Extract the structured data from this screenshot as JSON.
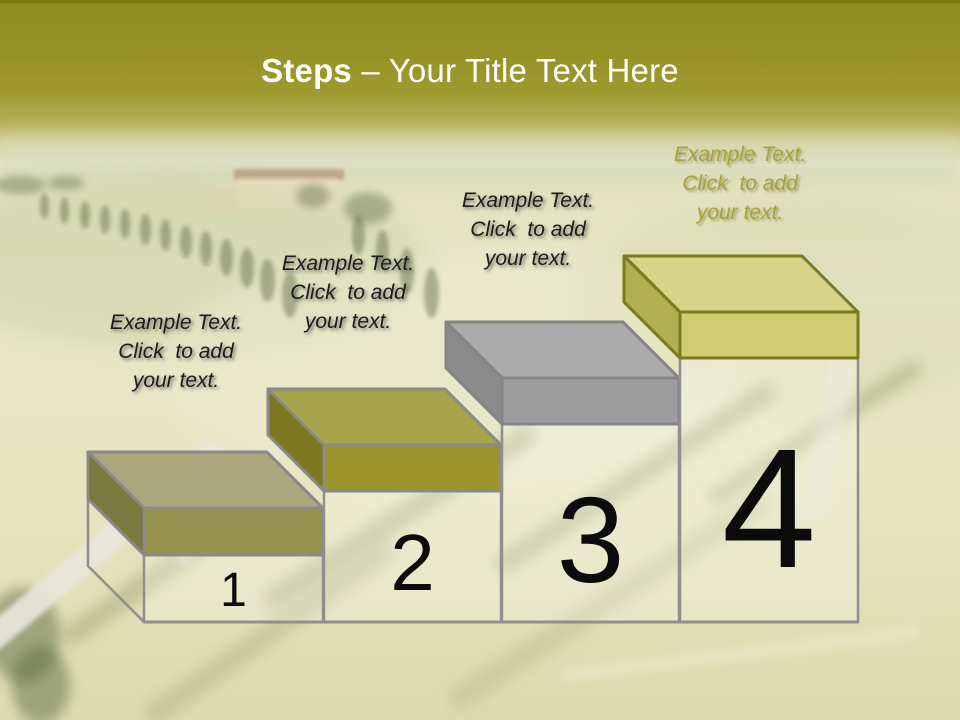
{
  "title": {
    "bold": "Steps",
    "rest": "– Your Title Text Here"
  },
  "theme": {
    "header_top": "#8e8b20",
    "header_bottom": "#a09b30",
    "title_color": "#ffffff",
    "background_field": "#e7e5c0",
    "column_fill": "rgba(255,255,255,0.25)",
    "column_stroke": "#8f8f8f",
    "baseline_color": "#8f8f8f",
    "number_color": "#0b0b0b"
  },
  "steps": [
    {
      "number": "1",
      "label": [
        "Example Text.",
        "Click  to add",
        "your text."
      ],
      "label_color": "#1c1c1c",
      "colors": {
        "top": "#a9a77b",
        "side": "#7b7840",
        "front": "#95914f",
        "outline": "#8a8a8a"
      }
    },
    {
      "number": "2",
      "label": [
        "Example Text.",
        "Click  to add",
        "your text."
      ],
      "label_color": "#1c1c1c",
      "colors": {
        "top": "#a7a348",
        "side": "#7d7820",
        "front": "#9a942a",
        "outline": "#8a8a8a"
      }
    },
    {
      "number": "3",
      "label": [
        "Example Text.",
        "Click  to add",
        "your text."
      ],
      "label_color": "#1c1c1c",
      "colors": {
        "top": "#ababab",
        "side": "#8b8b8b",
        "front": "#9d9d9d",
        "outline": "#858585"
      }
    },
    {
      "number": "4",
      "label": [
        "Example Text.",
        "Click  to add",
        "your text."
      ],
      "label_color": "#a49e2f",
      "colors": {
        "top": "#d7d489",
        "side": "#b2af52",
        "front": "#cfcc72",
        "outline": "#7b7a1c"
      }
    }
  ]
}
